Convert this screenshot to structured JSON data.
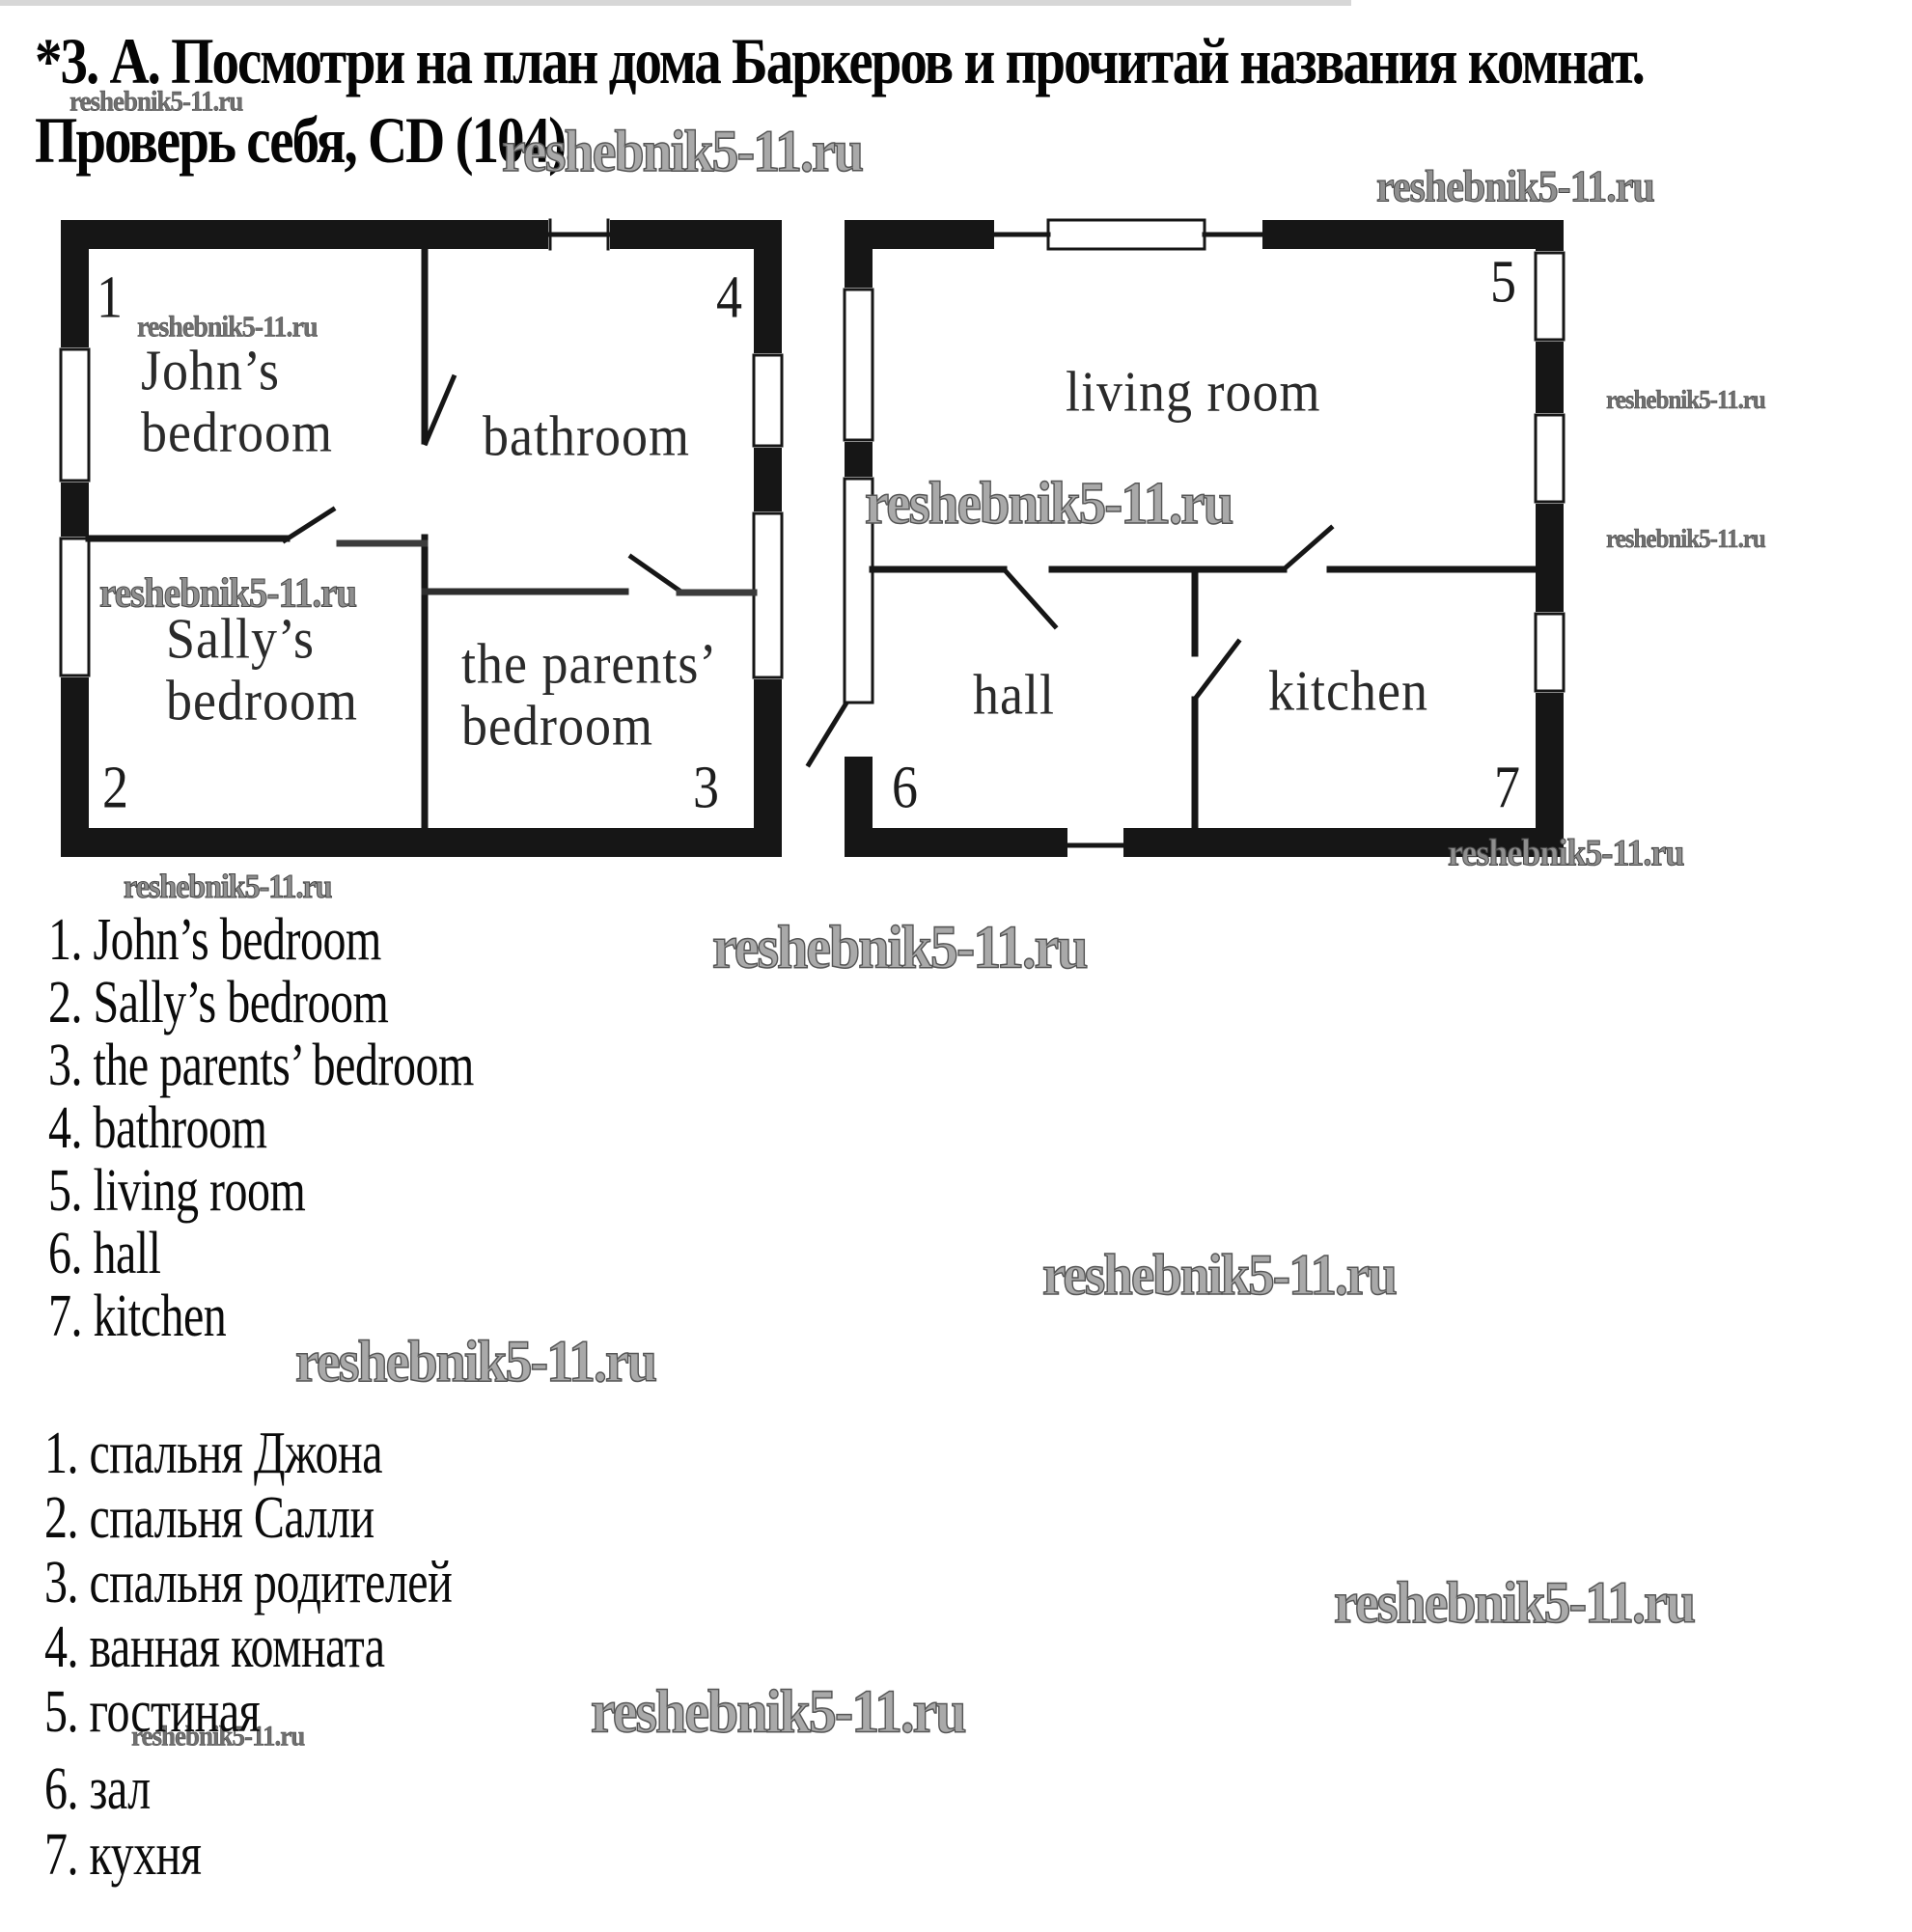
{
  "watermark": "reshebnik5-11.ru",
  "title": {
    "line1": "*3. А. Посмотри на план дома Баркеров и прочитай названия комнат.",
    "line2": "Проверь себя, CD (104)."
  },
  "floor_plans": {
    "left": {
      "room1_number": "1",
      "room1_line1": "John’s",
      "room1_line2": "bedroom",
      "room2_number": "2",
      "room2_line1": "Sally’s",
      "room2_line2": "bedroom",
      "room3_number": "3",
      "room3_line1": "the parents’",
      "room3_line2": "bedroom",
      "room4_number": "4",
      "room4_name": "bathroom"
    },
    "right": {
      "room5_number": "5",
      "room5_name": "living room",
      "room6_number": "6",
      "room6_name": "hall",
      "room7_number": "7",
      "room7_name": "kitchen"
    }
  },
  "answers_en": [
    "1. John’s bedroom",
    "2. Sally’s bedroom",
    "3. the parents’ bedroom",
    "4. bathroom",
    "5. living room",
    "6. hall",
    "7. kitchen"
  ],
  "answers_ru": [
    "1. спальня Джона",
    "2. спальня Салли",
    "3. спальня родителей",
    "4. ванная комната",
    "5. гостиная",
    "6. зал",
    "7. кухня"
  ]
}
